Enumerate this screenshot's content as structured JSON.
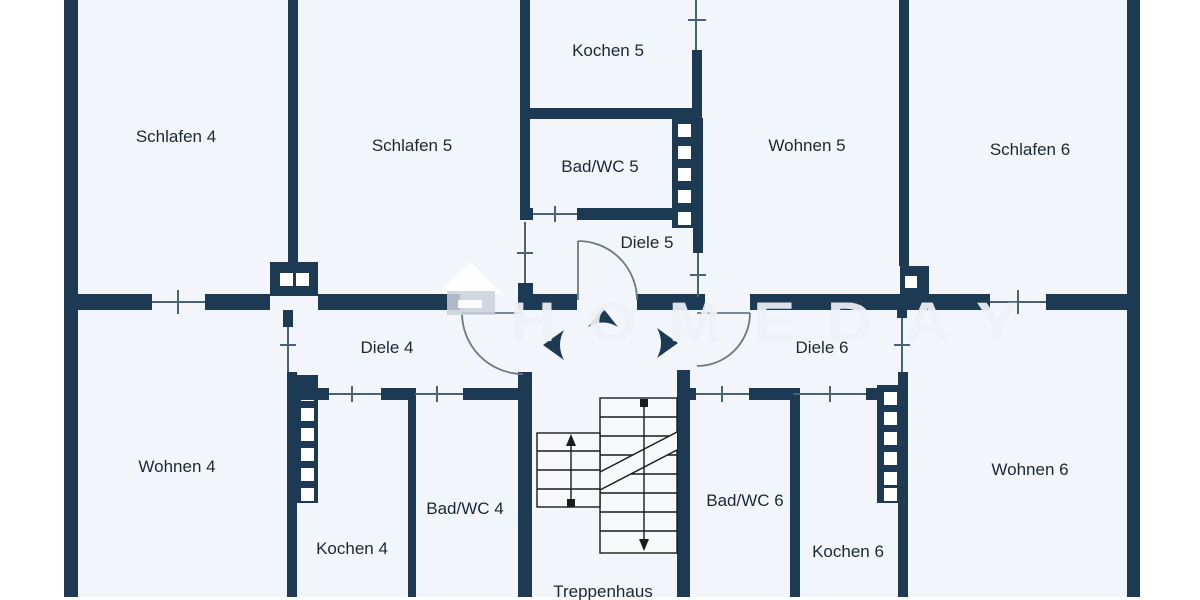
{
  "plan": {
    "type": "floor-plan",
    "floor_label": "Treppenhaus level with apartments 4, 5 and 6"
  },
  "colors": {
    "wall": "#1d3a55",
    "room": "#f2f5f9",
    "outside": "#ffffff",
    "line": "#4a617a",
    "door": "#6a7888",
    "stair": "#1b1b1b",
    "label": "#1b2836",
    "watermark": "#eef2f6"
  },
  "rooms": {
    "schlafen4": "Schlafen 4",
    "schlafen5": "Schlafen 5",
    "kochen5": "Kochen 5",
    "badwc5": "Bad/WC 5",
    "diele5": "Diele 5",
    "wohnen5": "Wohnen 5",
    "schlafen6": "Schlafen 6",
    "diele4": "Diele 4",
    "diele6": "Diele 6",
    "wohnen4": "Wohnen 4",
    "kochen4": "Kochen 4",
    "badwc4": "Bad/WC 4",
    "treppenhaus": "Treppenhaus",
    "badwc6": "Bad/WC 6",
    "kochen6": "Kochen 6",
    "wohnen6": "Wohnen 6"
  },
  "watermark": {
    "text": "HOMEDAY",
    "logo": "homeday-house-logo"
  }
}
